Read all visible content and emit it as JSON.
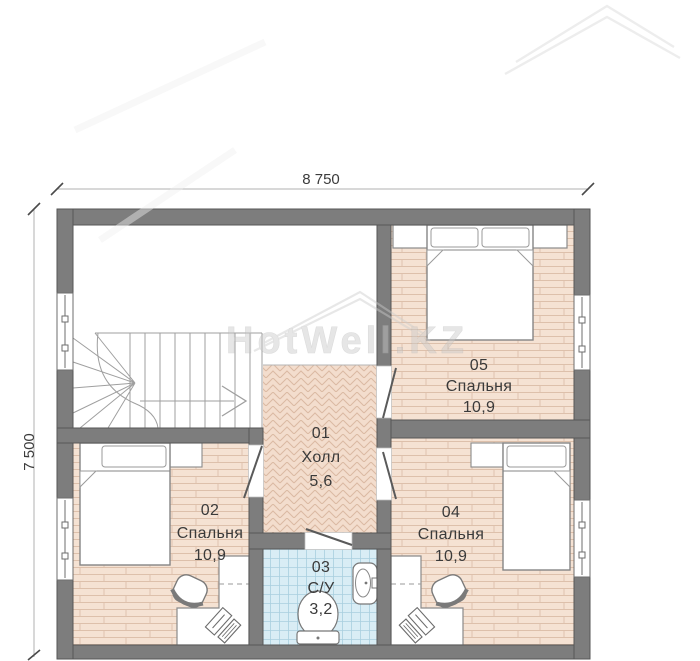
{
  "watermark": {
    "text": "HotWell.KZ"
  },
  "dimensions": {
    "top": "8 750",
    "left": "7 500"
  },
  "rooms": [
    {
      "number": "01",
      "name": "Холл",
      "area": "5,6"
    },
    {
      "number": "02",
      "name": "Спальня",
      "area": "10,9"
    },
    {
      "number": "03",
      "name": "С/У",
      "area": "3,2"
    },
    {
      "number": "04",
      "name": "Спальня",
      "area": "10,9"
    },
    {
      "number": "05",
      "name": "Спальня",
      "area": "10,9"
    }
  ],
  "colors": {
    "wall": "#7d7d7d",
    "wall_outline": "#565656",
    "bedroom_floor": "#f5e2d3",
    "bedroom_floor_line": "#ddc0ab",
    "hall_floor": "#f3ddcd",
    "hall_floor_line": "#dab9a2",
    "bathroom_floor": "#d9edf5",
    "bathroom_floor_line": "#a9cfdf",
    "furniture_stroke": "#7a7a7a",
    "label_text": "#3a3a3a",
    "watermark_gray": "#c9c9c9"
  }
}
